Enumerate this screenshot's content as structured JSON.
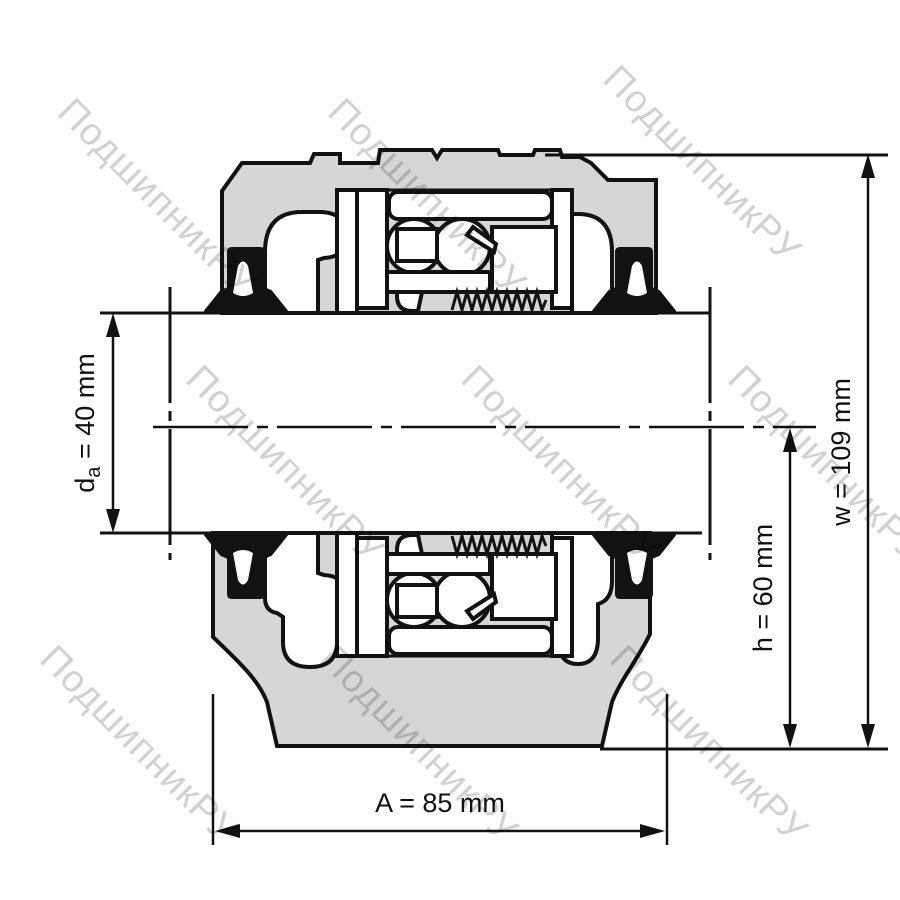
{
  "watermark": {
    "text": "ПодшипникРУ"
  },
  "dimensions": {
    "da": {
      "symbol": "d",
      "subscript": "a",
      "rest": " = 40 mm"
    },
    "h": {
      "label": "h = 60 mm"
    },
    "w": {
      "label": "w = 109 mm"
    },
    "A": {
      "label": "A = 85 mm"
    }
  },
  "colors": {
    "housing_fill": "#d6d6d6",
    "line": "#121212",
    "watermark": "rgba(0,0,0,0.18)",
    "background": "#ffffff"
  }
}
